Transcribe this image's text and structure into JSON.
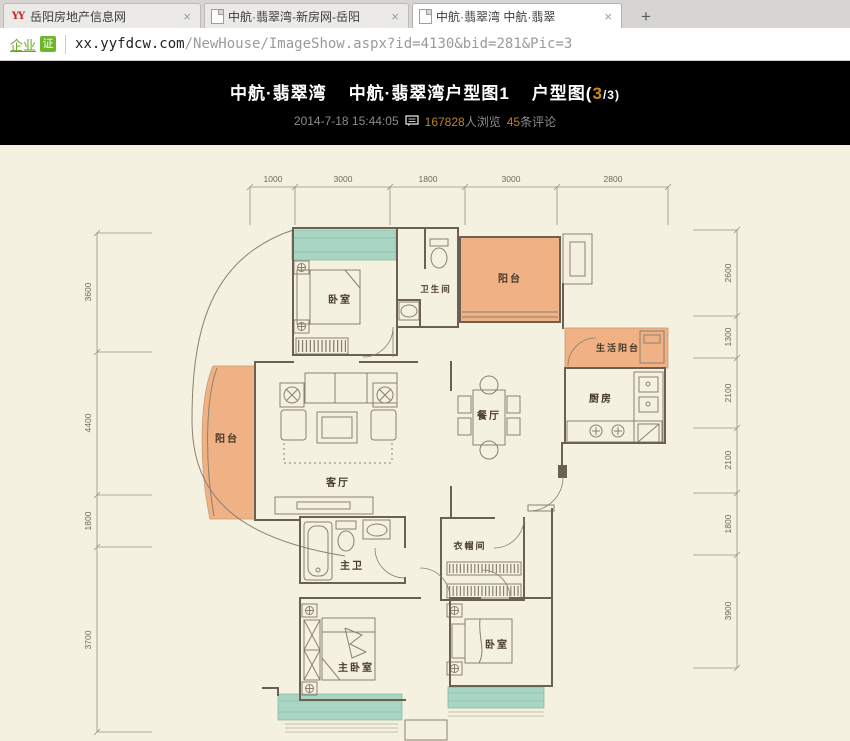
{
  "window": {
    "tabs": [
      {
        "title": "岳阳房地产信息网"
      },
      {
        "title": "中航·翡翠湾-新房网-岳阳"
      },
      {
        "title": "中航·翡翠湾  中航·翡翠"
      }
    ],
    "new_tab_label": "+",
    "close_label": "×",
    "favicon_logo_text": "YY"
  },
  "address": {
    "cert_link": "企业",
    "cert_badge": "证",
    "url_host": "xx.yyfdcw.com",
    "url_path": "/NewHouse/ImageShow.aspx?id=4130&bid=281&Pic=3"
  },
  "header": {
    "title_part1": "中航·翡翠湾",
    "title_part2": "中航·翡翠湾户型图1",
    "title_part3": "户型图(",
    "page_current": "3",
    "page_rest": "/3)",
    "date": "2014-7-18 15:44:05",
    "views": "167828",
    "views_label": "人浏览",
    "comments": "45",
    "comments_label": "条评论"
  },
  "floorplan": {
    "dims_top": [
      "1000",
      "3000",
      "1800",
      "3000",
      "2800"
    ],
    "dims_left": [
      "3600",
      "4400",
      "1800",
      "3700"
    ],
    "dims_right": [
      "2600",
      "1300",
      "2100",
      "2100",
      "1800",
      "3900"
    ],
    "rooms": {
      "bedroom_tl": "卧室",
      "bathroom": "卫生间",
      "balcony_top": "阳台",
      "life_balcony": "生活阳台",
      "kitchen": "厨房",
      "dining": "餐厅",
      "living": "客厅",
      "balcony_left": "阳台",
      "master_bath": "主卫",
      "closet": "衣帽间",
      "master_bedroom": "主卧室",
      "bedroom_br": "卧室"
    },
    "colors": {
      "balcony_orange": "#f0b185",
      "window_teal": "#a8d6c3",
      "background_cream": "#f5f1e0",
      "accent_orange": "#cf8a1a",
      "cert_green": "#6fb52b"
    }
  }
}
